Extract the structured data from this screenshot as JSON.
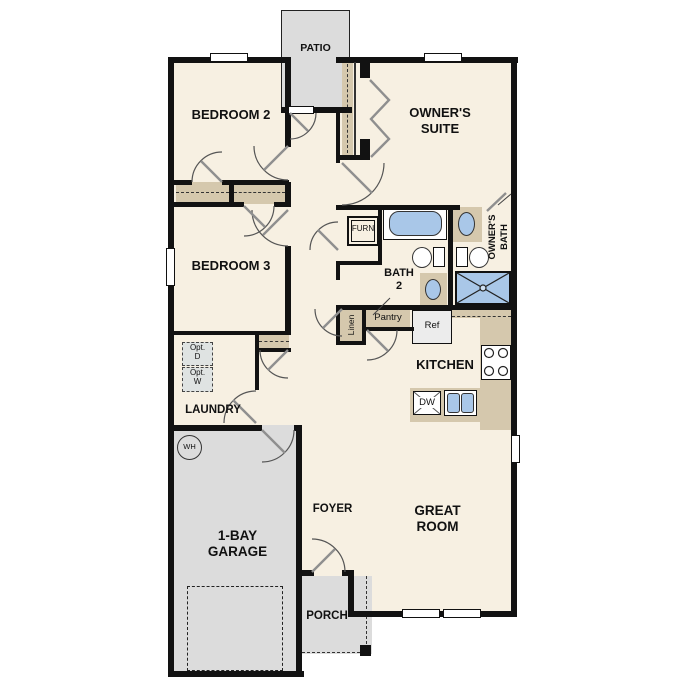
{
  "title": "Single-story floor plan",
  "colors": {
    "floor": "#f7f0e2",
    "wall": "#121212",
    "closet": "#d5c8ad",
    "surface": "#dcdcdc",
    "fixture": "#a9c7e8",
    "appliance": "#dfe3e2",
    "ref": "#ececec"
  },
  "rooms": {
    "patio": "PATIO",
    "bedroom2": "BEDROOM 2",
    "owners_suite": "OWNER'S\nSUITE",
    "owners_bath": "OWNER'S\nBATH",
    "bedroom3": "BEDROOM 3",
    "bath2": "BATH\n2",
    "kitchen": "KITCHEN",
    "laundry": "LAUNDRY",
    "garage": "1-BAY\nGARAGE",
    "foyer": "FOYER",
    "great_room": "GREAT\nROOM",
    "porch": "PORCH"
  },
  "fixtures": {
    "furnace": "FURN",
    "linen": "Linen",
    "pantry": "Pantry",
    "refrigerator": "Ref",
    "dishwasher": "DW",
    "optional_dryer": "Opt.\nD",
    "optional_washer": "Opt.\nW",
    "water_heater": "WH"
  }
}
